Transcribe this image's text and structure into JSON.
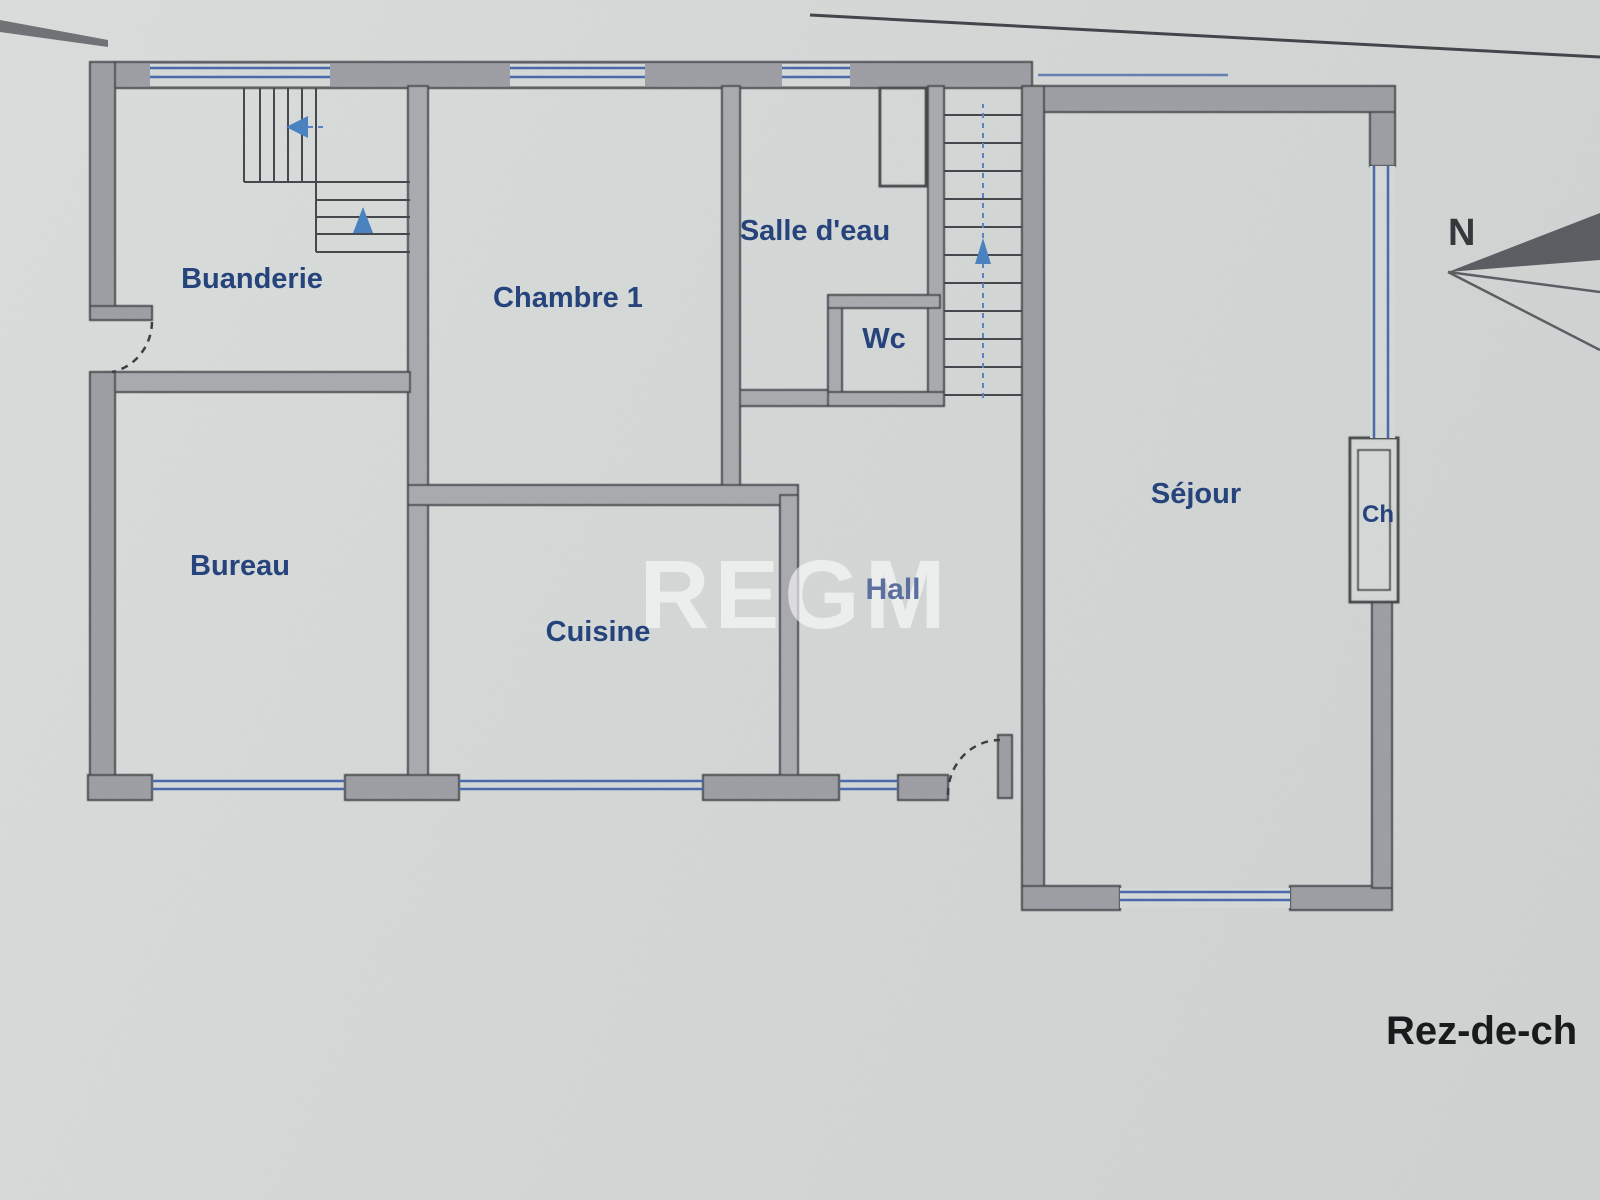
{
  "floor_plan": {
    "watermark": "REGM",
    "compass_label": "N",
    "floor_title": "Rez-de-ch",
    "rooms": [
      {
        "id": "buanderie",
        "label": "Buanderie"
      },
      {
        "id": "chambre-1",
        "label": "Chambre 1"
      },
      {
        "id": "salle-eau",
        "label": "Salle d'eau"
      },
      {
        "id": "wc",
        "label": "Wc"
      },
      {
        "id": "bureau",
        "label": "Bureau"
      },
      {
        "id": "cuisine",
        "label": "Cuisine"
      },
      {
        "id": "hall",
        "label": "Hall"
      },
      {
        "id": "sejour",
        "label": "Séjour"
      },
      {
        "id": "cheminee",
        "label": "Ch"
      }
    ],
    "colors": {
      "paper": "#d6dad8",
      "wall_fill": "#9ea0a5",
      "wall_stroke": "#45464b",
      "window_blue": "#4a6aad",
      "arrow_blue": "#4a82c2",
      "label_navy": "#24427c",
      "title_black": "#17181a",
      "watermark_white": "rgba(255,255,255,0.62)"
    }
  }
}
